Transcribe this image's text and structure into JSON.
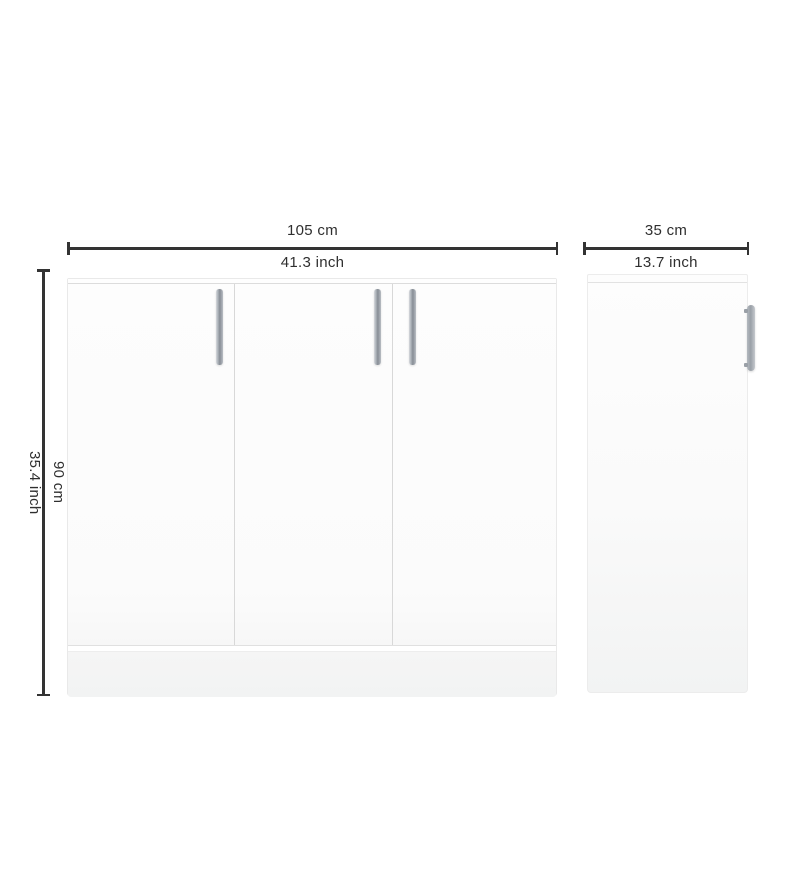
{
  "diagram": {
    "width": {
      "cm": "105 cm",
      "inch": "41.3 inch"
    },
    "depth": {
      "cm": "35 cm",
      "inch": "13.7 inch"
    },
    "height": {
      "cm": "90 cm",
      "inch": "35.4 inch"
    }
  },
  "views": {
    "front": {
      "door_count": 3,
      "handle_count": 3
    },
    "side": {
      "handle_count": 1
    }
  },
  "colors": {
    "background": "#ffffff",
    "dimension_line": "#333333",
    "label_text": "#2f2f2f",
    "cabinet_fill": "#fcfcfc",
    "cabinet_border": "#e9e9e9",
    "door_gap": "#d8d8d8",
    "plinth": "#f2f3f3",
    "handle_light": "#d6d9dd",
    "handle_dark": "#878d95"
  }
}
